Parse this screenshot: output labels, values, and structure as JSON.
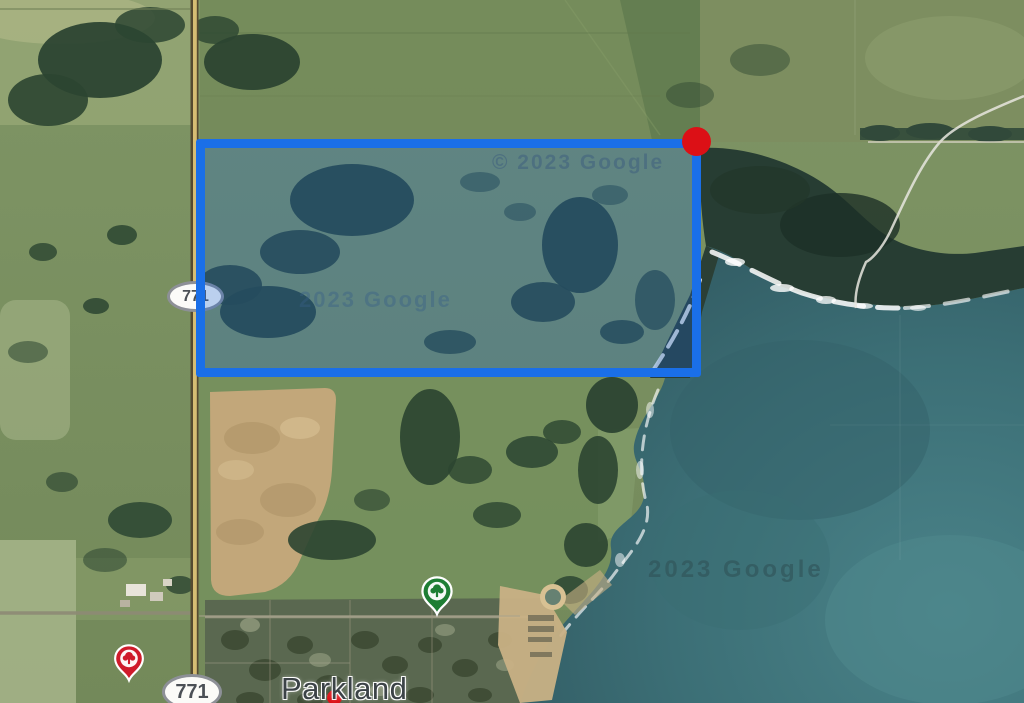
{
  "map": {
    "imagery": "satellite",
    "town_label": "Parkland",
    "road_shields": [
      {
        "label": "771"
      },
      {
        "label": "771"
      }
    ],
    "watermarks": [
      {
        "text": "© 2023 Google"
      },
      {
        "text": "2023 Google"
      },
      {
        "text": "2023 Google"
      }
    ],
    "pois": [
      {
        "icon": "park-pin-green"
      },
      {
        "icon": "poi-pin-red"
      }
    ]
  },
  "annotation": {
    "boundary_shape": "rectangle",
    "corner_marker": "red-dot"
  },
  "colors": {
    "boundary_blue": "#1a6fe8",
    "boundary_fill": "rgba(21,96,211,0.28)",
    "marker_red": "#dc1016",
    "pin_green": "#1e7e34",
    "pin_red": "#cf1b2b",
    "field_green": "#7b9160",
    "water_teal": "#3f767c",
    "tree_dark": "#2c4531",
    "sand_tan": "#c6ac7e",
    "road_yellow": "#d6bd73"
  }
}
